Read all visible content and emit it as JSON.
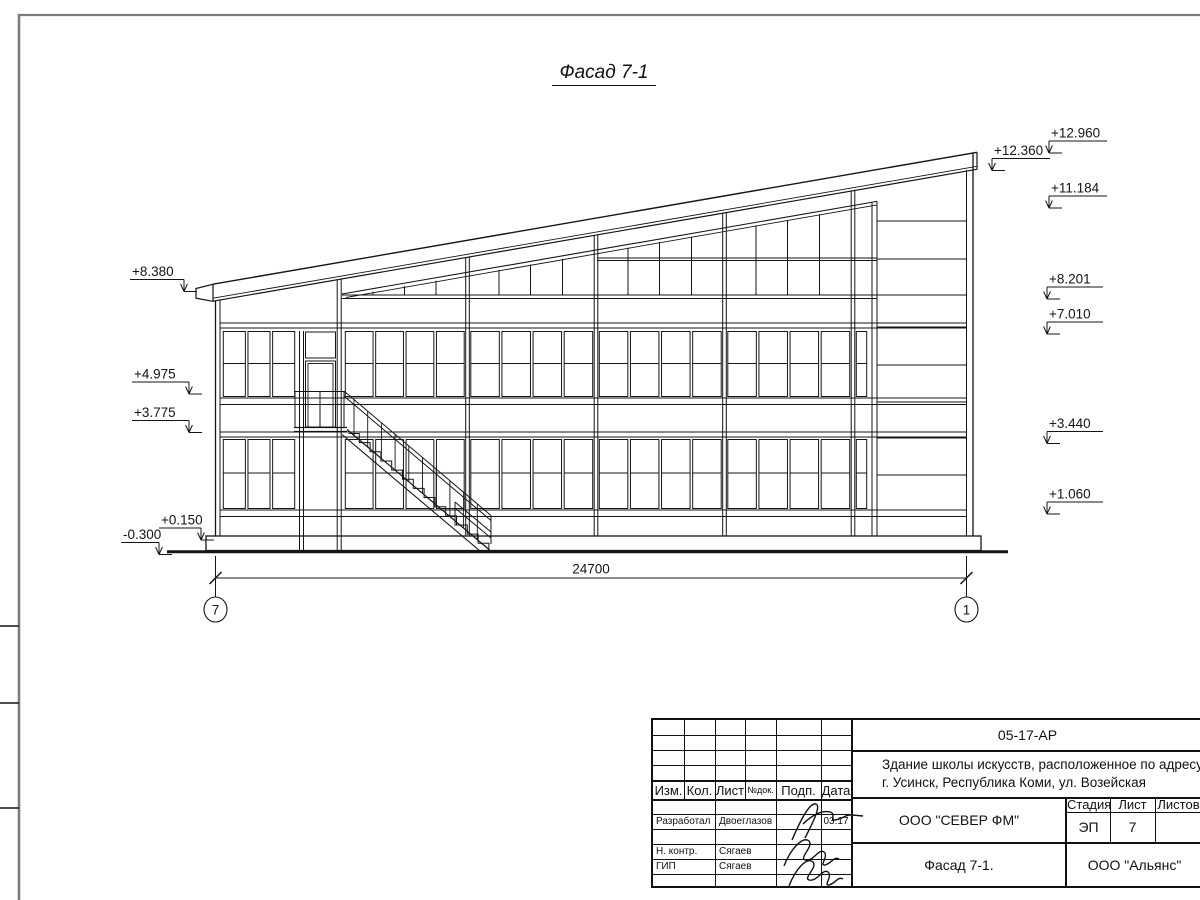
{
  "drawing": {
    "title": "Фасад 7-1",
    "dimension": "24700",
    "axis_left": "7",
    "axis_right": "1",
    "elevations_left": [
      "+8.380",
      "+4.975",
      "+3.775",
      "+0.150",
      "-0.300"
    ],
    "elevations_right": [
      "+12.960",
      "+12.360",
      "+11.184",
      "+8.201",
      "+7.010",
      "+3.440",
      "+1.060"
    ]
  },
  "titleblock": {
    "doc_code": "05-17-АР",
    "object_name_line1": "Здание школы искусств, расположенное по адресу:",
    "object_name_line2": "г. Усинск, Республика Коми, ул. Возейская",
    "org": "ООО \"СЕВЕР ФМ\"",
    "sheet_title": "Фасад 7-1.",
    "contractor": "ООО \"Альянс\"",
    "stage_label": "Стадия",
    "sheet_label": "Лист",
    "sheets_label": "Листов",
    "stage_value": "ЭП",
    "sheet_value": "7",
    "sheets_value": "",
    "cols": [
      "Изм.",
      "Кол.",
      "Лист",
      "№док.",
      "Подп.",
      "Дата"
    ],
    "rows": [
      {
        "role": "Разработал",
        "name": "Двоеглазов",
        "date": "03.17"
      },
      {
        "role": "Н. контр.",
        "name": "Сягаев",
        "date": ""
      },
      {
        "role": "ГИП",
        "name": "Сягаев",
        "date": ""
      }
    ]
  }
}
